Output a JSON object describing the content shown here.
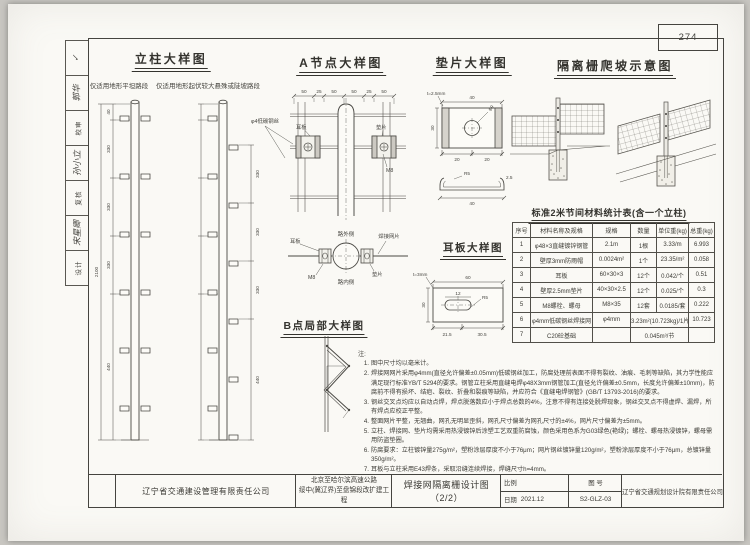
{
  "page": {
    "number": "274"
  },
  "signature_strip": {
    "items": [
      "✓",
      "郭华",
      "校审",
      "孙小立",
      "复核",
      "宋星卿",
      "设计"
    ]
  },
  "titles": {
    "column_detail": "立柱大样图",
    "column_sub_flat": "仅适用地形平坦路段",
    "column_sub_slope": "仅适用地形起伏较大悬殊或陡坡路段",
    "node_a": "A节点大样图",
    "washer": "垫片大样图",
    "climb": "隔离栅爬坡示意图",
    "ear_plate": "耳板大样图",
    "point_b": "B点局部大样图",
    "material_table": "标准2米节间材料统计表(含一个立柱)"
  },
  "labels": {
    "ear_plate": "耳板",
    "washer": "垫片",
    "bolt": "M8",
    "road_outer": "路外侧",
    "road_inner": "路内侧",
    "welded_mesh": "焊接网片",
    "phi4_wire": "φ4低碳钢丝",
    "washer_thickness": "t=2.5mm",
    "ear_thickness": "t=3mm",
    "hole": "φ9",
    "radius": "R5"
  },
  "dims": {
    "node_a_top": [
      "50",
      "25",
      "50",
      "50",
      "25",
      "50"
    ],
    "column_left": [
      "40",
      "330",
      "330",
      "330",
      "440"
    ],
    "column_total": "2100",
    "column_right": [
      "330",
      "330",
      "330",
      "440"
    ],
    "washer_top": "40",
    "washer_left": "30",
    "washer_bottom": [
      "20",
      "20"
    ],
    "washer_section": [
      "R5",
      "2.5",
      "40"
    ],
    "ear_top": "60",
    "ear_left": "30",
    "ear_slot": "12",
    "ear_bottom": [
      "21.5",
      "30.5"
    ]
  },
  "material_table": {
    "headers": [
      "序号",
      "材料名称及规格",
      "规格",
      "数量",
      "单位重(kg)",
      "总重(kg)"
    ],
    "rows": [
      [
        "1",
        "φ48×3直缝镀锌钢管",
        "2.1m",
        "1根",
        "3.33/m",
        "6.993"
      ],
      [
        "2",
        "壁厚3mm防雨帽",
        "0.0024m²",
        "1个",
        "23.35/m²",
        "0.058"
      ],
      [
        "3",
        "耳板",
        "60×30×3",
        "12个",
        "0.042/个",
        "0.51"
      ],
      [
        "4",
        "壁厚2.5mm垫片",
        "40×30×2.5",
        "12个",
        "0.025/个",
        "0.3"
      ],
      [
        "5",
        "M8螺栓、螺母",
        "M8×35",
        "12套",
        "0.0185/套",
        "0.222"
      ],
      [
        "6",
        "φ4mm低碳钢丝焊接网",
        "φ4mm",
        "3.23m²(10.723kg)/1片",
        "10.723"
      ],
      [
        "7",
        "C20砼基础",
        "",
        "0.045m³/节",
        ""
      ]
    ]
  },
  "notes": {
    "label": "注:",
    "items": [
      {
        "n": "1.",
        "text": "图中尺寸均以毫米计。"
      },
      {
        "n": "2.",
        "text": "焊接网网片采用φ4mm(直径允许偏差±0.05mm)低碳钢丝加工，防腐处理前表面不得有裂纹、油痕、毛刺等缺陷，其力学性能应满足现行标准YB/T 5294的要求。钢管立柱采用直缝电焊φ48X3mm钢管加工(直径允许偏差±0.5mm，长度允许偏差±10mm)，防腐前不得有损坏、结疤、裂纹、折叠和裂痕等缺陷，并应符合《直缝电焊钢管》(GB/T 13793-2016)的要求。"
      },
      {
        "n": "3.",
        "text": "钢丝交叉点均应以自动点焊，焊点脱落数应小于焊点总数的4%，注意不得有连接处脱焊现象，钢丝交叉点不得虚焊、漏焊，所有焊点应校正平整。"
      },
      {
        "n": "4.",
        "text": "整面网片平整，无翘曲，网孔无明显歪斜，网孔尺寸偏差为网孔尺寸的±4%，网片尺寸偏差为±5mm。"
      },
      {
        "n": "5.",
        "text": "立柱、焊接网、垫片均需采用热浸镀锌后涂塑工艺双重防腐蚀，颜色采用色系为G03绿色(艳绿)；螺栓、螺母热浸镀锌，螺母需用防盗垫圈。"
      },
      {
        "n": "6.",
        "text": "防腐要求：立柱镀锌量275g/m²，塑粉涂层厚度不小于76μm；网片钢丝镀锌量120g/m²，塑粉涂层厚度不小于76μm，总镀锌量350g/m²。"
      },
      {
        "n": "7.",
        "text": "耳板与立柱采用E43焊条，采取沿缝连续焊接，焊缝尺寸h=4mm。"
      }
    ]
  },
  "title_block": {
    "owner": "辽宁省交通建设管理有限责任公司",
    "project_line1": "北京至哈尔滨高速公路",
    "project_line2": "绥中(冀辽界)至盘锦段改扩建工程",
    "drawing_title": "焊接网隔离栅设计图（2/2）",
    "scale_label": "比例",
    "date_label": "日期",
    "date_value": "2021.12",
    "fig_label": "图 号",
    "fig_value": "S2-GLZ-03",
    "designer": "辽宁省交通规划设计院有限责任公司"
  }
}
